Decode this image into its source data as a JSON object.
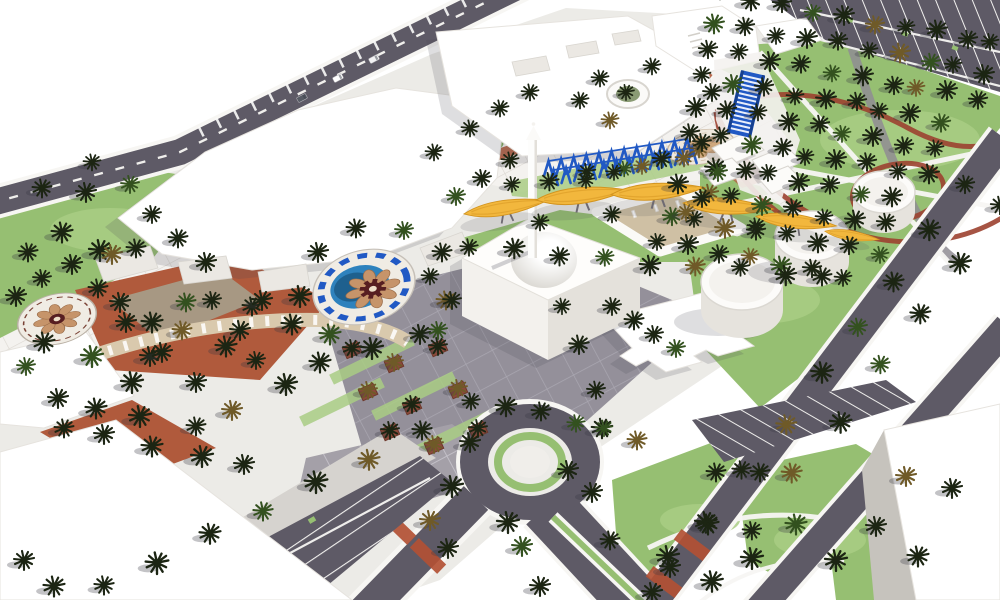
{
  "scene": {
    "palette": {
      "sky": "#ffffff",
      "paving": "#ecebe7",
      "plazaLight": "#f4f2ef",
      "tileGray": "#94909a",
      "forecourtGray": "#a4a0a8",
      "sidewalk": "#d6d3cf",
      "curb": "#f7f6f3",
      "road": "#5e5a66",
      "grass": "#96bf72",
      "grassLight": "#a9cc84",
      "grassDark": "#7fa95c",
      "palm": "#1c2513",
      "terracotta": "#b05a3c",
      "redPath": "#9c4130",
      "crosswalk": "#b25034",
      "yellow": "#f2b73d",
      "yellowDark": "#d3941f",
      "blue": "#2159c4",
      "blueDark": "#17408f",
      "poolBlue": "#2e82bd",
      "poolDark": "#1b5a86",
      "mosaicCream": "#f0ece4",
      "mosaicTan": "#c6946a",
      "mosaicMaroon": "#571e21",
      "tanFloor": "#cfc0a4",
      "bldgWhite": "#ffffff",
      "bldgShade": "#e9e6e1",
      "bldgShade2": "#d7d4ce",
      "bldgShade3": "#c6c3bd"
    },
    "palms": {
      "grids": [
        {
          "o": [
            724,
            -6
          ],
          "c": [
            30,
            5.5
          ],
          "r": [
            -7,
            27.5
          ],
          "nc": 10,
          "nr": 10,
          "s": 0.92
        }
      ],
      "lines": [
        {
          "f": [
            108,
            588
          ],
          "t": [
            420,
            430
          ],
          "n": 7,
          "s": 1.05
        },
        {
          "f": [
            472,
            246
          ],
          "t": [
            826,
            278
          ],
          "n": 9,
          "s": 0.95
        },
        {
          "f": [
            514,
            186
          ],
          "t": [
            696,
            152
          ],
          "n": 6,
          "s": 0.85
        },
        {
          "f": [
            966,
            182
          ],
          "t": [
            672,
            568
          ],
          "n": 9,
          "s": 1.0
        },
        {
          "f": [
            1000,
            206
          ],
          "t": [
            714,
            582
          ],
          "n": 8,
          "s": 1.0
        },
        {
          "f": [
            470,
            398
          ],
          "t": [
            640,
            438
          ],
          "n": 6,
          "s": 0.95
        },
        {
          "f": [
            560,
            306
          ],
          "t": [
            608,
            430
          ],
          "n": 4,
          "s": 0.9
        }
      ],
      "clusters": [
        [
          318,
          252,
          1,
          0
        ],
        [
          300,
          296,
          1.1,
          0
        ],
        [
          330,
          334,
          1.05,
          1
        ],
        [
          372,
          348,
          1.1,
          0
        ],
        [
          420,
          334,
          1,
          0
        ],
        [
          446,
          300,
          0.95,
          2
        ],
        [
          442,
          252,
          0.95,
          0
        ],
        [
          404,
          230,
          0.9,
          1
        ],
        [
          356,
          228,
          0.95,
          0
        ],
        [
          16,
          296,
          1,
          0
        ],
        [
          44,
          342,
          1.05,
          0
        ],
        [
          92,
          356,
          1.1,
          1
        ],
        [
          126,
          322,
          1,
          0
        ],
        [
          98,
          288,
          0.95,
          0
        ],
        [
          42,
          278,
          0.9,
          0
        ],
        [
          150,
          356,
          1,
          0
        ],
        [
          182,
          330,
          0.95,
          2
        ],
        [
          212,
          300,
          0.9,
          0
        ],
        [
          240,
          330,
          1,
          0
        ],
        [
          42,
          188,
          0.95,
          0
        ],
        [
          86,
          192,
          1,
          0
        ],
        [
          130,
          184,
          0.9,
          1
        ],
        [
          62,
          232,
          1.05,
          0
        ],
        [
          100,
          250,
          1.1,
          0
        ],
        [
          28,
          252,
          0.95,
          0
        ],
        [
          72,
          264,
          1,
          0
        ],
        [
          112,
          254,
          1,
          2
        ],
        [
          136,
          248,
          0.95,
          0
        ],
        [
          92,
          162,
          0.85,
          0
        ],
        [
          152,
          214,
          0.9,
          0
        ],
        [
          178,
          238,
          0.95,
          0
        ],
        [
          206,
          262,
          1,
          0
        ],
        [
          58,
          398,
          1,
          0
        ],
        [
          96,
          408,
          1.05,
          0
        ],
        [
          140,
          416,
          1.1,
          0
        ],
        [
          26,
          366,
          0.9,
          1
        ],
        [
          104,
          434,
          1,
          0
        ],
        [
          152,
          446,
          1.05,
          0
        ],
        [
          202,
          456,
          1.1,
          0
        ],
        [
          64,
          428,
          0.95,
          0
        ],
        [
          244,
          464,
          1,
          0
        ],
        [
          120,
          302,
          1,
          0
        ],
        [
          152,
          322,
          1.05,
          0
        ],
        [
          186,
          302,
          0.95,
          1
        ],
        [
          162,
          352,
          1,
          0
        ],
        [
          132,
          382,
          1.1,
          0
        ],
        [
          196,
          382,
          1,
          0
        ],
        [
          226,
          346,
          1.05,
          0
        ],
        [
          252,
          306,
          0.95,
          0
        ],
        [
          232,
          410,
          1,
          2
        ],
        [
          196,
          426,
          0.95,
          0
        ],
        [
          262,
          300,
          1,
          0
        ],
        [
          292,
          324,
          1.05,
          0
        ],
        [
          286,
          384,
          1.1,
          0
        ],
        [
          320,
          362,
          1.05,
          0
        ],
        [
          256,
          360,
          0.9,
          0
        ],
        [
          452,
          486,
          1.1,
          0
        ],
        [
          470,
          442,
          1,
          0
        ],
        [
          508,
          522,
          1.1,
          0
        ],
        [
          522,
          546,
          1,
          1
        ],
        [
          448,
          548,
          1,
          0
        ],
        [
          568,
          470,
          1,
          0
        ],
        [
          592,
          492,
          1,
          0
        ],
        [
          540,
          586,
          1,
          0
        ],
        [
          610,
          540,
          0.95,
          0
        ],
        [
          430,
          520,
          1,
          2
        ],
        [
          612,
          306,
          0.9,
          0
        ],
        [
          634,
          320,
          0.95,
          0
        ],
        [
          654,
          334,
          0.9,
          0
        ],
        [
          676,
          348,
          0.9,
          1
        ],
        [
          540,
          222,
          0.85,
          0
        ],
        [
          612,
          214,
          0.85,
          0
        ],
        [
          686,
          212,
          0.85,
          2
        ],
        [
          756,
          226,
          0.85,
          0
        ],
        [
          510,
          160,
          0.85,
          0
        ],
        [
          482,
          178,
          0.9,
          0
        ],
        [
          456,
          196,
          0.9,
          1
        ],
        [
          434,
          152,
          0.85,
          0
        ],
        [
          470,
          128,
          0.85,
          0
        ],
        [
          500,
          108,
          0.85,
          0
        ],
        [
          530,
          92,
          0.85,
          0
        ],
        [
          600,
          78,
          0.85,
          0
        ],
        [
          652,
          66,
          0.85,
          0
        ],
        [
          610,
          120,
          0.85,
          2
        ],
        [
          580,
          100,
          0.85,
          0
        ],
        [
          626,
          92,
          0.8,
          0
        ],
        [
          712,
          92,
          0.9,
          0
        ],
        [
          702,
          142,
          0.9,
          0
        ],
        [
          718,
          172,
          0.9,
          1
        ],
        [
          702,
          198,
          0.9,
          0
        ],
        [
          668,
          556,
          1.1,
          0
        ],
        [
          708,
          524,
          1.05,
          0
        ],
        [
          752,
          558,
          1.1,
          0
        ],
        [
          796,
          524,
          1.05,
          1
        ],
        [
          836,
          560,
          1.1,
          0
        ],
        [
          876,
          526,
          1,
          0
        ],
        [
          918,
          556,
          1.05,
          0
        ],
        [
          952,
          488,
          1,
          0
        ],
        [
          906,
          476,
          1,
          2
        ],
        [
          716,
          472,
          0.95,
          0
        ],
        [
          760,
          472,
          0.95,
          0
        ],
        [
          652,
          592,
          1,
          0
        ],
        [
          24,
          560,
          1,
          0
        ],
        [
          54,
          586,
          1.05,
          0
        ],
        [
          452,
          300,
          0.9,
          0
        ],
        [
          438,
          330,
          0.9,
          1
        ],
        [
          430,
          276,
          0.85,
          0
        ],
        [
          586,
          180,
          0.8,
          0
        ],
        [
          614,
          172,
          0.8,
          0
        ],
        [
          642,
          166,
          0.8,
          2
        ]
      ]
    },
    "planters": [
      [
        352,
        350
      ],
      [
        394,
        364
      ],
      [
        438,
        348
      ],
      [
        368,
        392
      ],
      [
        412,
        406
      ],
      [
        458,
        390
      ],
      [
        390,
        432
      ],
      [
        434,
        446
      ],
      [
        478,
        430
      ]
    ],
    "canopies": [
      {
        "x": 506,
        "y": 208,
        "r": -8,
        "s": 0.92
      },
      {
        "x": 582,
        "y": 196,
        "r": -5,
        "s": 1.0
      },
      {
        "x": 658,
        "y": 192,
        "r": -3,
        "s": 1.02
      },
      {
        "x": 728,
        "y": 207,
        "r": 5,
        "s": 0.98
      },
      {
        "x": 796,
        "y": 222,
        "r": 8,
        "s": 0.88
      },
      {
        "x": 852,
        "y": 236,
        "r": 10,
        "s": 0.6
      }
    ],
    "pergola": {
      "x": 544,
      "y": 176,
      "n": 12,
      "dx": 12.6,
      "dy": -2.0,
      "h": 15,
      "w": 9
    },
    "stairs": {
      "x": 741,
      "y": 70,
      "rot": 13,
      "w": 25,
      "h": 64,
      "rungs": 13
    },
    "mosaics": [
      {
        "x": 364,
        "y": 287,
        "rot": -16,
        "sy": 0.7,
        "kind": "fountain"
      },
      {
        "x": 57,
        "y": 319,
        "rot": -14,
        "sy": 0.62,
        "kind": "small"
      },
      {
        "x": 701,
        "y": 147,
        "rot": -10,
        "sy": 0.5,
        "kind": "flat"
      }
    ],
    "cars": [
      [
        338,
        78,
        -28,
        "#ffffff"
      ],
      [
        374,
        59,
        -28,
        "#f2f2f4"
      ],
      [
        302,
        98,
        -28,
        "#575b64"
      ]
    ]
  }
}
